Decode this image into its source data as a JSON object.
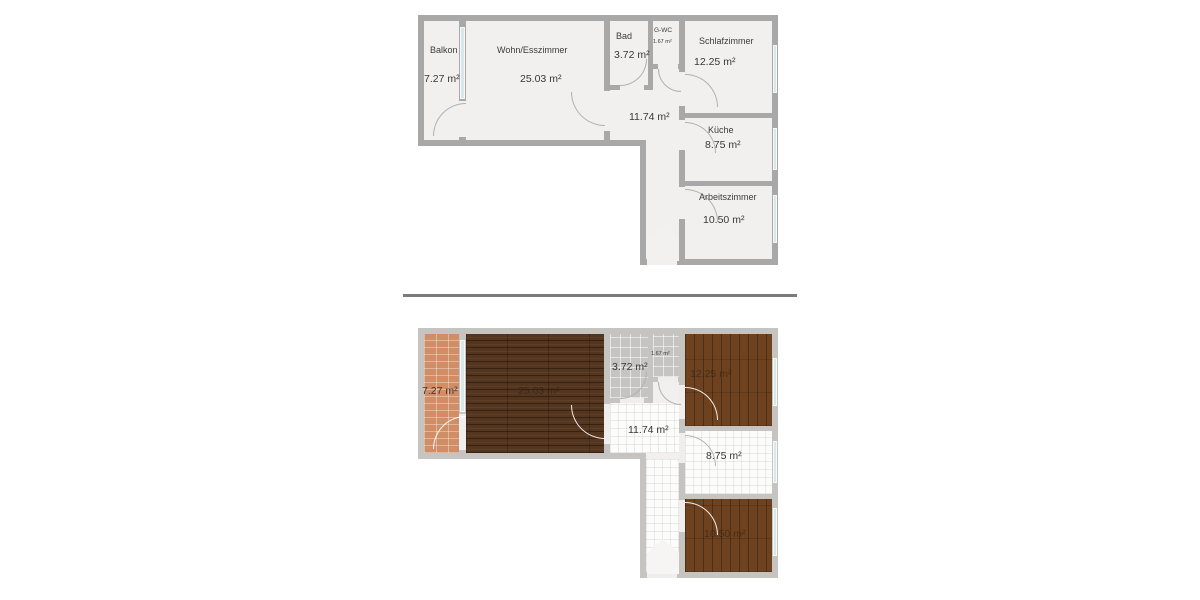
{
  "colors": {
    "wall": "#a8a8a8",
    "wall_light": "#c6c4c1",
    "room_fill": "#f1f0ee",
    "window_glass": "#d9e7e8",
    "divider": "#7b7b7b",
    "floor_terracotta": "#d18d66",
    "floor_wood_dark": "#54351e",
    "floor_wood_mid": "#6e421f",
    "floor_tile_gray": "#c5c4c3",
    "floor_tile_white": "#fcfcfb"
  },
  "plan_top": {
    "rooms": {
      "balkon": {
        "name": "Balkon",
        "area": "7.27 m²"
      },
      "wohn_esszimmer": {
        "name": "Wohn/Esszimmer",
        "area": "25.03 m²"
      },
      "bad": {
        "name": "Bad",
        "area": "3.72 m²"
      },
      "g_wc": {
        "name": "G-WC",
        "area": "1.67 m²"
      },
      "schlafzimmer": {
        "name": "Schlafzimmer",
        "area": "12.25 m²"
      },
      "flur": {
        "area": "11.74 m²"
      },
      "kueche": {
        "name": "Küche",
        "area": "8.75 m²"
      },
      "arbeitszimmer": {
        "name": "Arbeitszimmer",
        "area": "10.50 m²"
      }
    },
    "info": {
      "title": "Wohnung",
      "address_line1": "Obere Saarlandstr. 5",
      "address_line2": "1. Etage (Barrierefreier Zugang)",
      "address_line3": "45470 Mülheim-Ruhr",
      "bullets": [
        "Abgeschlossener Kellerraum",
        "Gemeinschaftsraum im Keller mit Anschlüssen für Waschmaschine und Trockner",
        "Tiefgaragenplatz vorhanden"
      ]
    }
  },
  "plan_bottom": {
    "areas": {
      "balkon": "7.27 m²",
      "wohn_esszimmer": "25.03 m²",
      "bad": "3.72 m²",
      "g_wc": "1.67 m²",
      "schlafzimmer": "12.25 m²",
      "flur": "11.74 m²",
      "kueche": "8.75 m²",
      "arbeitszimmer": "10.50 m²"
    },
    "info": {
      "line1": "Bodenbeläge",
      "line2": "Fliesen bzw. Laminat",
      "line3": "Einbauküche vorhanden",
      "highlight": "Möblierte Vermietung möglich!"
    }
  }
}
